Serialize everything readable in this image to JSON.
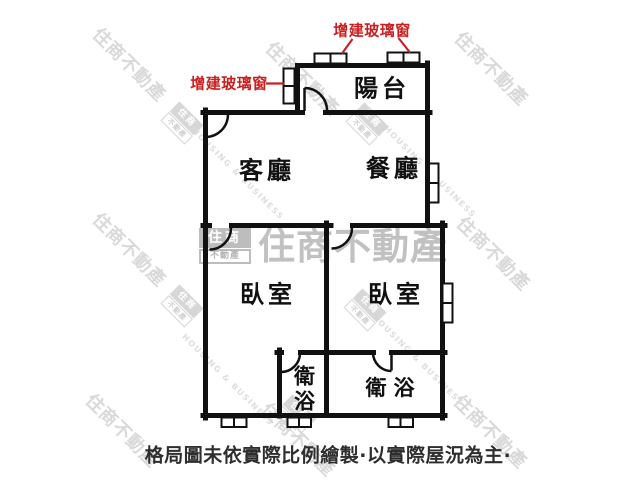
{
  "floor_plan": {
    "rooms": {
      "balcony": "陽台",
      "living_room": "客廳",
      "dining_room": "餐廳",
      "bedroom_left": "臥室",
      "bedroom_right": "臥室",
      "bathroom_left": "衛浴",
      "bathroom_right": "衛浴"
    },
    "annotations": {
      "window_note_top": "增建玻璃窗",
      "window_note_left": "增建玻璃窗"
    },
    "caption": "格局圖未依實際比例繪製·以實際屋況為主·"
  },
  "watermark": {
    "brand": "住商不動產",
    "brand_en": "HOUSING & BUSINESS",
    "logo_top": "住商",
    "logo_bottom": "不動產"
  },
  "colors": {
    "wall": "#111111",
    "annotation_red": "#c92121",
    "watermark_gray": "#d9d9d9"
  }
}
